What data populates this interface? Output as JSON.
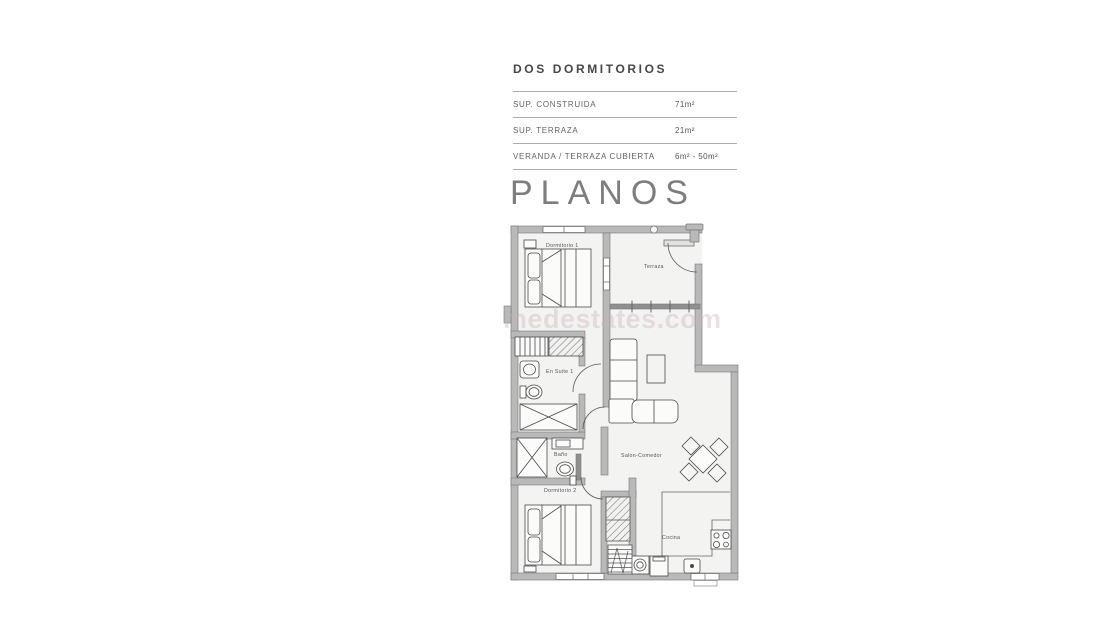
{
  "listing": {
    "title": "DOS DORMITORIOS",
    "specs": [
      {
        "label": "SUP.  CONSTRUIDA",
        "value": "71m²"
      },
      {
        "label": "SUP. TERRAZA",
        "value": "21m²"
      },
      {
        "label": "VERANDA / TERRAZA CUBIERTA",
        "value": "6m² - 50m²"
      }
    ],
    "section_heading": "PLANOS"
  },
  "floorplan": {
    "watermark": "medestates.com",
    "rooms": {
      "dormitorio1": "Dormitorio 1",
      "terraza": "Terraza",
      "ensuite1": "En Suite 1",
      "bano": "Baño",
      "dormitorio2": "Dormitorio 2",
      "salon": "Salon-Comedor",
      "cocina": "Cocina"
    },
    "colors": {
      "wall_fill": "#b9b9b9",
      "wall_edge": "#777777",
      "furniture_line": "#4a4a4a",
      "floor_fill": "#f3f3f2",
      "watermark_color": "#cdb2b2"
    }
  }
}
